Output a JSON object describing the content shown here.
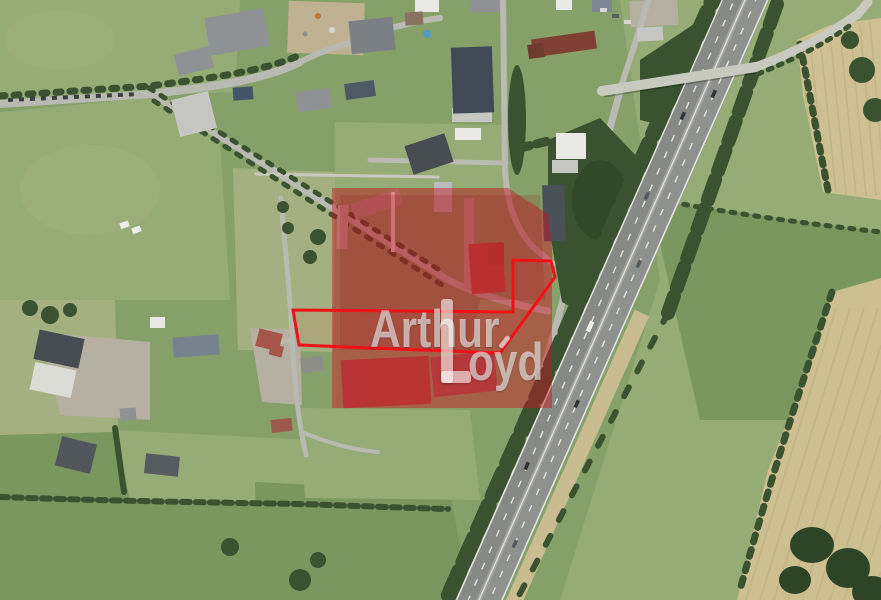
{
  "watermark": {
    "line1": "Arthur",
    "line2": "Loyd",
    "line2_rest": "oyd"
  },
  "overlay": {
    "fill_color": "#cc1220",
    "fill_opacity": "0.45",
    "blotch_color": "#8e0e1c",
    "outline_color": "#f01018"
  },
  "palette": {
    "field-base": "#86a069",
    "field-light": "#95ac76",
    "field-pale": "#a4b081",
    "field-dark": "#79975f",
    "trees": "#3a5230",
    "trees-dark": "#2e4427",
    "road": "#b9bab1",
    "road-light": "#c9cabf",
    "highway": "#8f918f",
    "highway-west": "#878986",
    "lane-white": "#e4e4de",
    "tan": "#cfc094",
    "tan-deep": "#cdbf90",
    "verge-tan": "#c8bc90",
    "plow-line": "#bcab7e",
    "dirt": "#c1b193",
    "yard": "#b5b0a2",
    "building-dark": "#474c52",
    "building-slate": "#3f4a56",
    "building-gray": "#8e9294",
    "building-light": "#c6c7c2",
    "building-white": "#e9eae5",
    "roof-red": "#8a4236",
    "roof-orange": "#a5554a",
    "pool-blue": "#4f9cc4",
    "wm-color": "rgba(255,255,255,0.58)"
  }
}
